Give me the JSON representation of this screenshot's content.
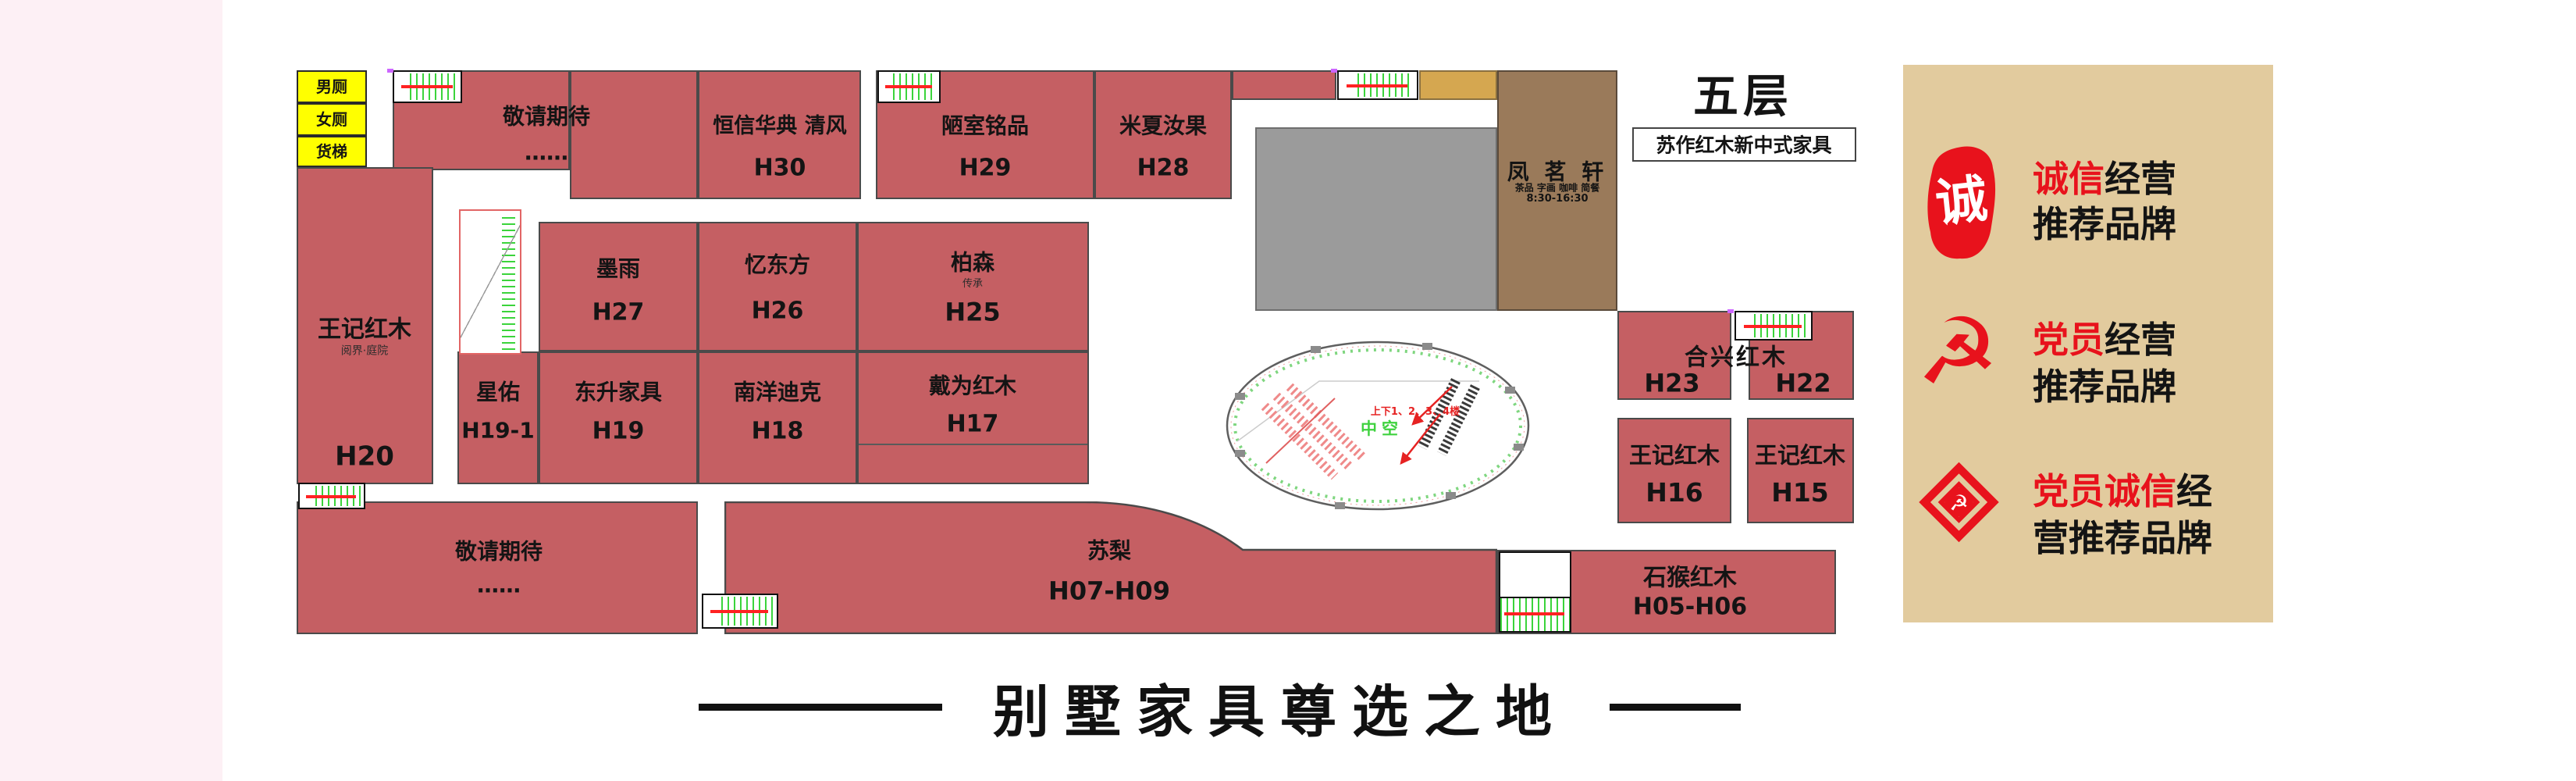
{
  "header": {
    "floor": "五层",
    "category": "苏作红木新中式家具"
  },
  "tagline": "别墅家具尊选之地",
  "facilities": {
    "toilet_m": "男厕",
    "toilet_f": "女厕",
    "freight": "货梯"
  },
  "atrium": {
    "label": "中空",
    "direction": "上下1、2、3、4楼"
  },
  "stores": {
    "await_top": {
      "name": "敬请期待",
      "dots": "……"
    },
    "h30": {
      "name": "恒信华典 清风",
      "number": "H30"
    },
    "h29": {
      "name": "陋室铭品",
      "number": "H29"
    },
    "h28": {
      "name": "米夏汝果",
      "number": "H28"
    },
    "h20": {
      "name": "王记红木",
      "sub": "阅界·庭院",
      "number": "H20"
    },
    "h27": {
      "name": "墨雨",
      "number": "H27"
    },
    "h26": {
      "name": "忆东方",
      "number": "H26"
    },
    "h25": {
      "name": "柏森",
      "sub": "传承",
      "number": "H25"
    },
    "h19_1": {
      "name": "星佑",
      "number": "H19-1"
    },
    "h19": {
      "name": "东升家具",
      "number": "H19"
    },
    "h18": {
      "name": "南洋迪克",
      "number": "H18"
    },
    "h17": {
      "name": "戴为红木",
      "number": "H17"
    },
    "hexing": {
      "name": "合兴红木",
      "left_number": "H23",
      "right_number": "H22"
    },
    "h16": {
      "name": "王记红木",
      "number": "H16"
    },
    "h15": {
      "name": "王记红木",
      "number": "H15"
    },
    "await_bottom": {
      "name": "敬请期待",
      "dots": "……"
    },
    "suli": {
      "name": "苏梨",
      "number": "H07-H09"
    },
    "shihou": {
      "name": "石猴红木",
      "number": "H05-H06"
    },
    "fengmingxuan": {
      "name": "凤 茗 轩",
      "services": "茶品 字画 咖啡 简餐",
      "hours": "8:30-16:30"
    }
  },
  "sidebar": {
    "items": [
      {
        "icon": "seal-stamp-icon",
        "seal_char": "诚",
        "line1_red": "诚信",
        "line1_black": "经营",
        "line2_red": "",
        "line2_black": "推荐品牌"
      },
      {
        "icon": "party-emblem-icon",
        "emblem_char": "☭",
        "line1_red": "党员",
        "line1_black": "经营",
        "line2_red": "",
        "line2_black": "推荐品牌"
      },
      {
        "icon": "party-diamond-icon",
        "emblem_char": "☭",
        "line1_red": "党员诚信",
        "line1_black": "经",
        "line2_red": "",
        "line2_black": "营推荐品牌"
      }
    ]
  },
  "colors": {
    "block_red": "#c55f63",
    "highlight_yellow": "#ffff00",
    "atrium_green": "#3fd23f",
    "note_red": "#e62222",
    "seal_red": "#e8121c",
    "sidebar_tan": "#e2cb9e",
    "gray_block": "#9b9b9b",
    "brown_block": "#9a7a5a",
    "gold_block": "#d5a750",
    "pink_margin": "#fdf0f5"
  }
}
